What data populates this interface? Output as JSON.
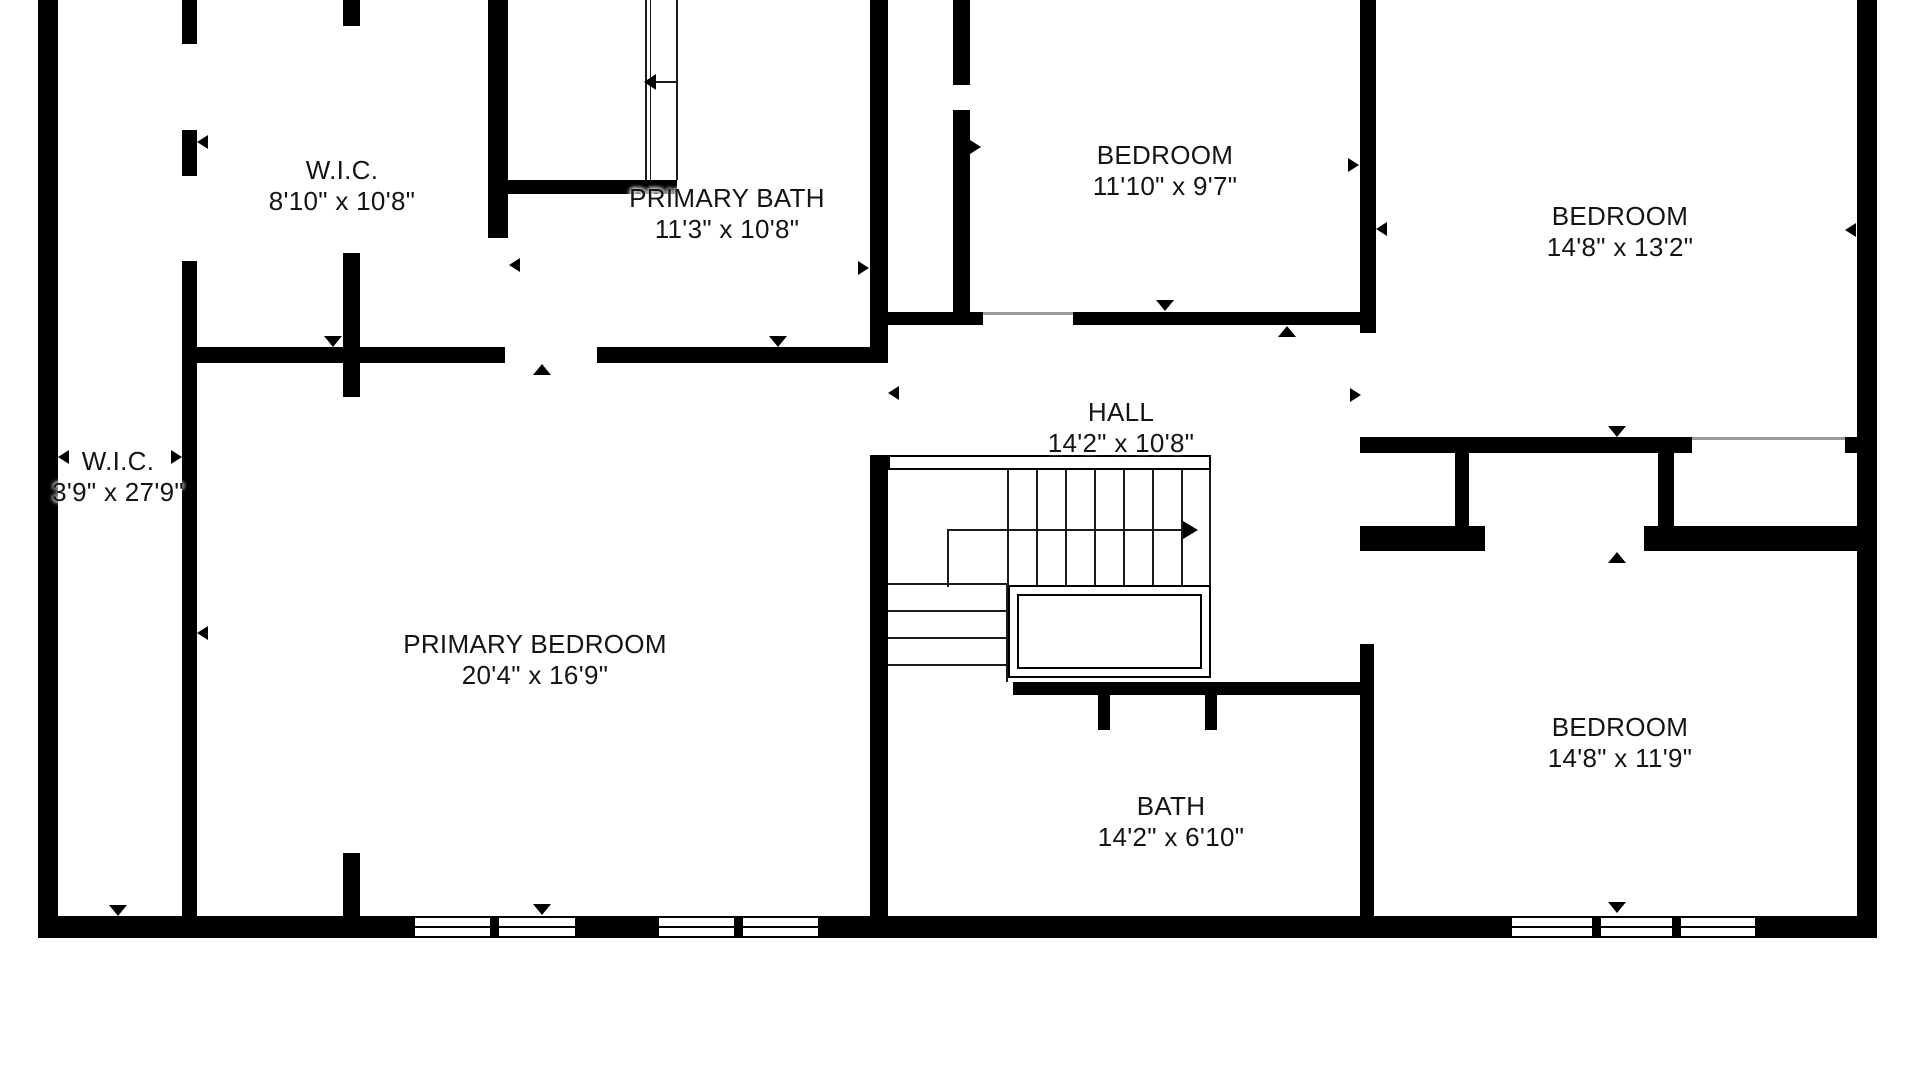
{
  "plan": {
    "background": "#ffffff",
    "wall_color": "#000000",
    "unit_note": "feet-inches"
  },
  "rooms": [
    {
      "id": "wic-top",
      "name": "W.I.C.",
      "dims": "8'10\" x 10'8\""
    },
    {
      "id": "primary-bath",
      "name": "PRIMARY BATH",
      "dims": "11'3\" x 10'8\""
    },
    {
      "id": "bedroom-middle",
      "name": "BEDROOM",
      "dims": "11'10\" x 9'7\""
    },
    {
      "id": "bedroom-top-right",
      "name": "BEDROOM",
      "dims": "14'8\" x 13'2\""
    },
    {
      "id": "wic-left",
      "name": "W.I.C.",
      "dims": "3'9\" x 27'9\""
    },
    {
      "id": "hall",
      "name": "HALL",
      "dims": "14'2\" x 10'8\""
    },
    {
      "id": "primary-bedroom",
      "name": "PRIMARY BEDROOM",
      "dims": "20'4\" x 16'9\""
    },
    {
      "id": "bath",
      "name": "BATH",
      "dims": "14'2\" x 6'10\""
    },
    {
      "id": "bedroom-bottom-right",
      "name": "BEDROOM",
      "dims": "14'8\" x 11'9\""
    }
  ]
}
